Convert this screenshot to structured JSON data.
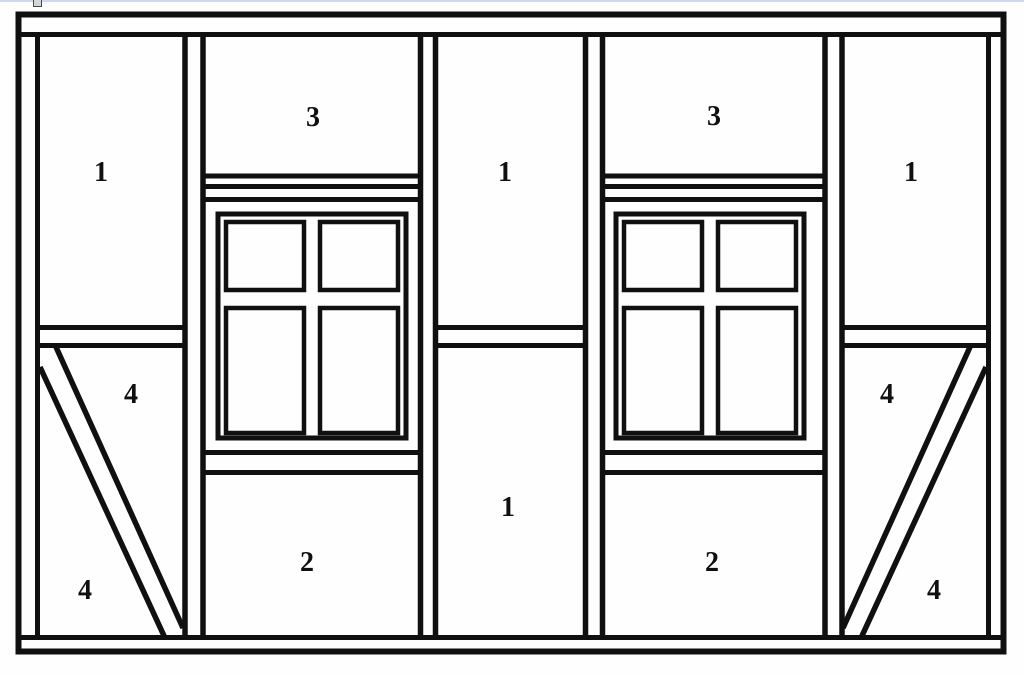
{
  "window_chrome": {
    "top_edge_color": "#cdd9ee",
    "artifact_icon": {
      "name": "cropped-favicon-square",
      "fill_color": "#d6d6d6",
      "border_color": "#4a4a4a"
    }
  },
  "diagram": {
    "stroke_color": "#101010",
    "background_color": "#fefefe",
    "panel_labels": [
      {
        "id": "left-bay-top",
        "text": "1"
      },
      {
        "id": "window-bay-left-top",
        "text": "3"
      },
      {
        "id": "center-bay-top",
        "text": "1"
      },
      {
        "id": "window-bay-right-top",
        "text": "3"
      },
      {
        "id": "right-bay-top",
        "text": "1"
      },
      {
        "id": "left-bay-brace-upper",
        "text": "4"
      },
      {
        "id": "right-bay-brace-upper",
        "text": "4"
      },
      {
        "id": "center-bay-bottom",
        "text": "1"
      },
      {
        "id": "window-bay-left-bottom",
        "text": "2"
      },
      {
        "id": "window-bay-right-bottom",
        "text": "2"
      },
      {
        "id": "left-bay-brace-lower",
        "text": "4"
      },
      {
        "id": "right-bay-brace-lower",
        "text": "4"
      }
    ]
  }
}
